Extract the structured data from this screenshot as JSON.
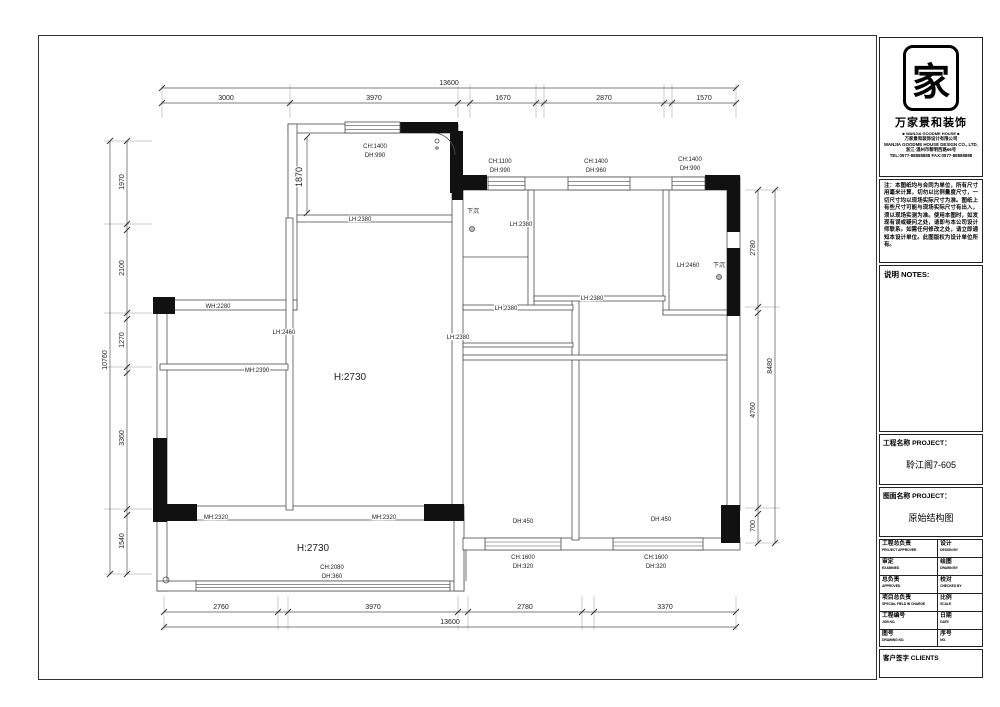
{
  "titleblock": {
    "logo_char": "家",
    "brand_cn": "万家景和装饰",
    "brand_en": "■ WANJIA GOODME HOUSE ■",
    "company_lines": [
      "万家景和装饰设计有限公司",
      "WANJIA GOODME HOUSE DESIGN CO., LTD.",
      "浙江·温州市黎明西路66号",
      "TEL:0577-88888888  FAX:0577-88888888"
    ],
    "disclaimer": "注：本图纸均与合同为单位，所有尺寸用毫米计算，切勿以比例量度尺寸，一切尺寸均以现场实际尺寸为准。图纸上有些尺寸可能与现场实际尺寸有出入，须以现场实测为准。使用本图时，如发现有误或疑问之处，请即与本公司设计师联系。如需任何修改之处，请立即通知本设计单位。此图版权为设计单位所有。",
    "notes_label": "说明  NOTES:",
    "project_label": "工程名称 PROJECT：",
    "project_value": "聆江阁7-605",
    "drawing_label": "图面名称 PROJECT：",
    "drawing_value": "原始结构图",
    "table": [
      {
        "l_cn": "工程总负责",
        "l_en": "PROJECT APPROVER",
        "r_cn": "设计",
        "r_en": "DESIGN BY"
      },
      {
        "l_cn": "审定",
        "l_en": "EXAMINED",
        "r_cn": "绘图",
        "r_en": "DRAWN BY"
      },
      {
        "l_cn": "总负责",
        "l_en": "APPROVED",
        "r_cn": "校对",
        "r_en": "CHECKED BY"
      },
      {
        "l_cn": "项目总负责",
        "l_en": "SPECIAL FIELD IN CHARGE",
        "r_cn": "比例",
        "r_en": "SCALE"
      },
      {
        "l_cn": "工程编号",
        "l_en": "JOB NO.",
        "r_cn": "日期",
        "r_en": "DATE"
      },
      {
        "l_cn": "图号",
        "l_en": "DRAWING NO.",
        "r_cn": "序号",
        "r_en": "NO."
      }
    ],
    "clients_label": "客户签字 CLIENTS"
  },
  "plan": {
    "labels": [
      {
        "t": "13600",
        "x": 449,
        "y": 85,
        "s": 7
      },
      {
        "t": "3000",
        "x": 226,
        "y": 100,
        "s": 7
      },
      {
        "t": "3970",
        "x": 374,
        "y": 100,
        "s": 7
      },
      {
        "t": "1670",
        "x": 503,
        "y": 100,
        "s": 7
      },
      {
        "t": "2870",
        "x": 604,
        "y": 100,
        "s": 7
      },
      {
        "t": "1570",
        "x": 704,
        "y": 100,
        "s": 7
      },
      {
        "t": "10760",
        "x": 107,
        "y": 360,
        "s": 7,
        "r": -90
      },
      {
        "t": "1970",
        "x": 124,
        "y": 182,
        "s": 7,
        "r": -90
      },
      {
        "t": "2100",
        "x": 124,
        "y": 268,
        "s": 7,
        "r": -90
      },
      {
        "t": "1270",
        "x": 124,
        "y": 340,
        "s": 7,
        "r": -90
      },
      {
        "t": "3360",
        "x": 124,
        "y": 438,
        "s": 7,
        "r": -90
      },
      {
        "t": "1540",
        "x": 124,
        "y": 541,
        "s": 7,
        "r": -90
      },
      {
        "t": "2780",
        "x": 755,
        "y": 248,
        "s": 7,
        "r": -90
      },
      {
        "t": "4760",
        "x": 755,
        "y": 410,
        "s": 7,
        "r": -90
      },
      {
        "t": "700",
        "x": 755,
        "y": 526,
        "s": 7,
        "r": -90
      },
      {
        "t": "8480",
        "x": 772,
        "y": 366,
        "s": 7,
        "r": -90
      },
      {
        "t": "2760",
        "x": 221,
        "y": 609,
        "s": 7
      },
      {
        "t": "3970",
        "x": 373,
        "y": 609,
        "s": 7
      },
      {
        "t": "2780",
        "x": 525,
        "y": 609,
        "s": 7
      },
      {
        "t": "3370",
        "x": 665,
        "y": 609,
        "s": 7
      },
      {
        "t": "13600",
        "x": 450,
        "y": 624,
        "s": 7
      },
      {
        "t": "CH:1400",
        "x": 375,
        "y": 148,
        "s": 6
      },
      {
        "t": "DH:990",
        "x": 375,
        "y": 157,
        "s": 6
      },
      {
        "t": "1870",
        "x": 302,
        "y": 177,
        "s": 9,
        "r": -90
      },
      {
        "t": "CH:1100",
        "x": 500,
        "y": 163,
        "s": 6
      },
      {
        "t": "DH:990",
        "x": 500,
        "y": 172,
        "s": 6
      },
      {
        "t": "CH:1400",
        "x": 596,
        "y": 163,
        "s": 6
      },
      {
        "t": "DH:960",
        "x": 596,
        "y": 172,
        "s": 6
      },
      {
        "t": "CH:1400",
        "x": 690,
        "y": 161,
        "s": 6
      },
      {
        "t": "DH:990",
        "x": 690,
        "y": 170,
        "s": 6
      },
      {
        "t": "下沉",
        "x": 473,
        "y": 213,
        "s": 6
      },
      {
        "t": "LH:2380",
        "x": 521,
        "y": 226,
        "s": 6
      },
      {
        "t": "LH:2380",
        "x": 360,
        "y": 221,
        "s": 6
      },
      {
        "t": "LH:2460",
        "x": 688,
        "y": 267,
        "s": 6
      },
      {
        "t": "下沉",
        "x": 719,
        "y": 267,
        "s": 6
      },
      {
        "t": "WH:2280",
        "x": 218,
        "y": 308,
        "s": 6
      },
      {
        "t": "LH:2380",
        "x": 506,
        "y": 310,
        "s": 6
      },
      {
        "t": "LH:2380",
        "x": 592,
        "y": 300,
        "s": 6
      },
      {
        "t": "LH:2460",
        "x": 284,
        "y": 334,
        "s": 6
      },
      {
        "t": "LH:2380",
        "x": 458,
        "y": 339,
        "s": 6
      },
      {
        "t": "MH:2390",
        "x": 257,
        "y": 372,
        "s": 6
      },
      {
        "t": "H:2730",
        "x": 350,
        "y": 380,
        "s": 10
      },
      {
        "t": "MH:2320",
        "x": 216,
        "y": 519,
        "s": 6
      },
      {
        "t": "MH:2320",
        "x": 384,
        "y": 519,
        "s": 6
      },
      {
        "t": "H:2730",
        "x": 313,
        "y": 551,
        "s": 10
      },
      {
        "t": "CH:2080",
        "x": 332,
        "y": 569,
        "s": 6
      },
      {
        "t": "DH:360",
        "x": 332,
        "y": 578,
        "s": 6
      },
      {
        "t": "DH:450",
        "x": 523,
        "y": 523,
        "s": 6
      },
      {
        "t": "DH:450",
        "x": 661,
        "y": 521,
        "s": 6
      },
      {
        "t": "CH:1600",
        "x": 523,
        "y": 559,
        "s": 6
      },
      {
        "t": "DH:320",
        "x": 523,
        "y": 568,
        "s": 6
      },
      {
        "t": "CH:1600",
        "x": 656,
        "y": 559,
        "s": 6
      },
      {
        "t": "DH:320",
        "x": 656,
        "y": 568,
        "s": 6
      }
    ]
  }
}
